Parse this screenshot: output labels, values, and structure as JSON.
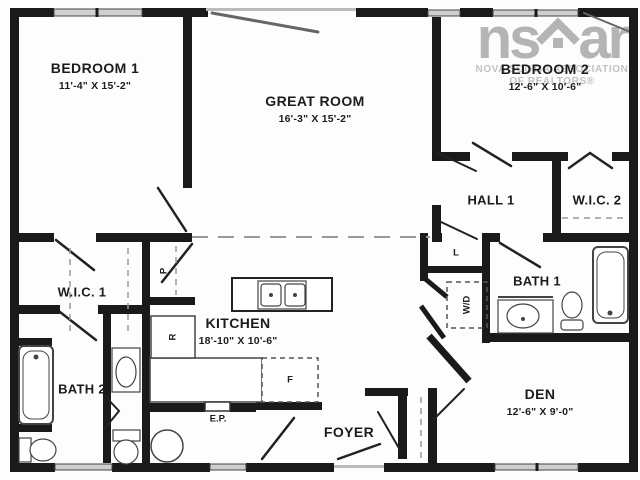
{
  "title": "Residential floor plan",
  "watermark": {
    "logo_left": "ns",
    "logo_right": "ar",
    "icon": "house-icon",
    "line1": "NOVA SCOTIA ASSOCIATION",
    "line2": "OF REALTORS®"
  },
  "rooms": {
    "bedroom1": {
      "name": "BEDROOM 1",
      "dims": "11'-4\" X 15'-2\""
    },
    "great_room": {
      "name": "GREAT ROOM",
      "dims": "16'-3\" X 15'-2\""
    },
    "bedroom2": {
      "name": "BEDROOM 2",
      "dims": "12'-6\" X 10'-6\""
    },
    "kitchen": {
      "name": "KITCHEN",
      "dims": "18'-10\" X 10'-6\""
    },
    "den": {
      "name": "DEN",
      "dims": "12'-6\" X 9'-0\""
    },
    "hall1": {
      "name": "HALL 1"
    },
    "wic1": {
      "name": "W.I.C. 1"
    },
    "wic2": {
      "name": "W.I.C. 2"
    },
    "bath1": {
      "name": "BATH 1"
    },
    "bath2": {
      "name": "BATH 2"
    },
    "foyer": {
      "name": "FOYER"
    }
  },
  "fixture_labels": {
    "electrical_panel": "E.P.",
    "pantry": "P",
    "refrigerator": "R",
    "furnace": "F",
    "linen": "L",
    "washer_dryer": "W/D"
  },
  "colors": {
    "wall": "#1a1a1a",
    "window_fill": "#cfcfcf",
    "watermark_gray": "#b4b4b4",
    "dashed_line": "#999999",
    "background": "#fdfdfd"
  }
}
